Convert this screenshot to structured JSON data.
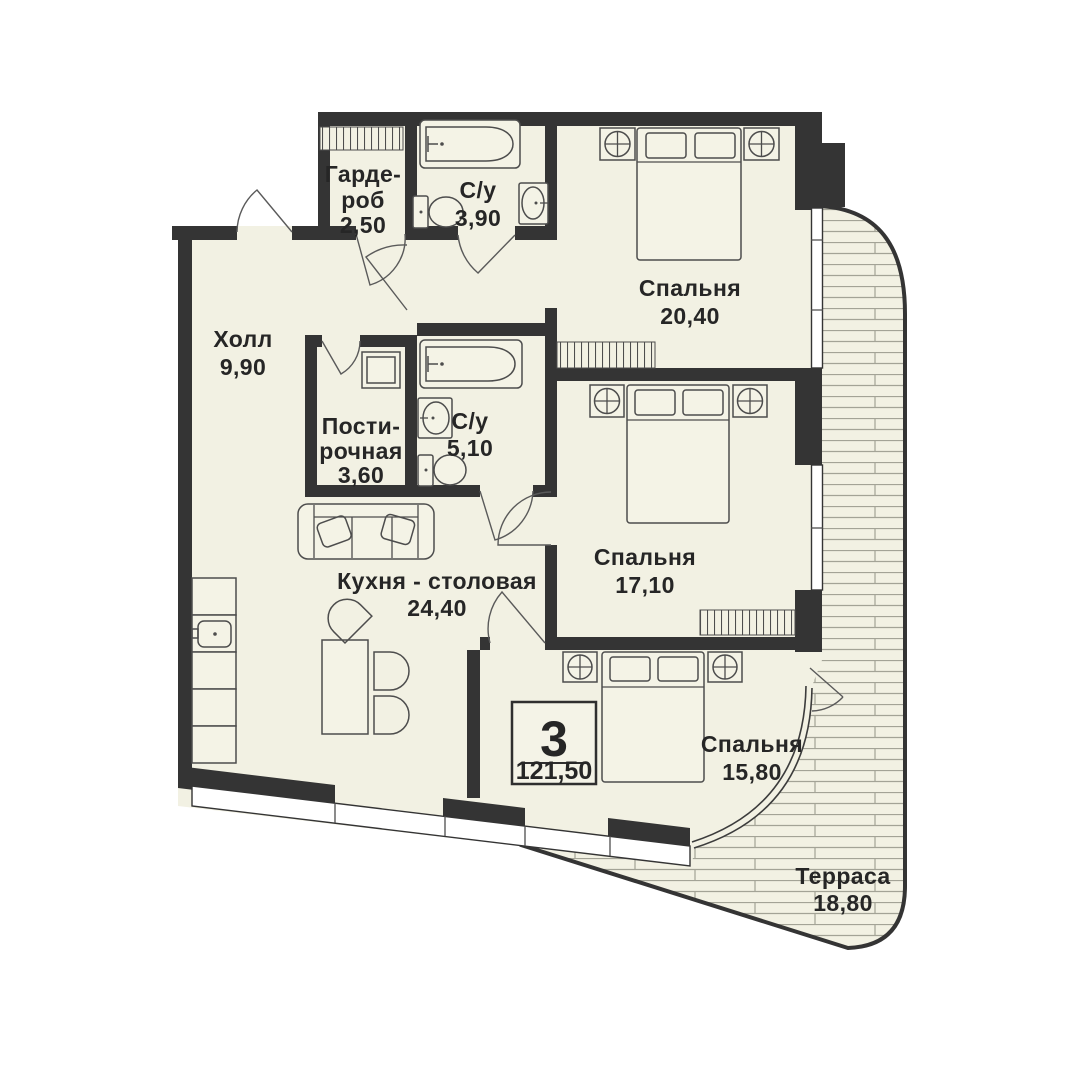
{
  "badge": {
    "rooms": "3",
    "area": "121,50"
  },
  "rooms": {
    "wardrobe": {
      "line1": "Гарде-",
      "line2": "роб",
      "area": "2,50"
    },
    "bathroom1": {
      "name": "С/у",
      "area": "3,90"
    },
    "bedroom1": {
      "name": "Спальня",
      "area": "20,40"
    },
    "hall": {
      "name": "Холл",
      "area": "9,90"
    },
    "laundry": {
      "line1": "Пости-",
      "line2": "рочная",
      "area": "3,60"
    },
    "bathroom2": {
      "name": "С/у",
      "area": "5,10"
    },
    "bedroom2": {
      "name": "Спальня",
      "area": "17,10"
    },
    "kitchen": {
      "name": "Кухня - столовая",
      "area": "24,40"
    },
    "bedroom3": {
      "name": "Спальня",
      "area": "15,80"
    },
    "terrace": {
      "name": "Терраса",
      "area": "18,80"
    }
  },
  "colors": {
    "background": "#ffffff",
    "wall": "#343434",
    "floor": "#f2f1e3",
    "terrace_joint_line": "#a3a396",
    "text": "#262626",
    "furniture_outline": "#4d4d4d"
  }
}
